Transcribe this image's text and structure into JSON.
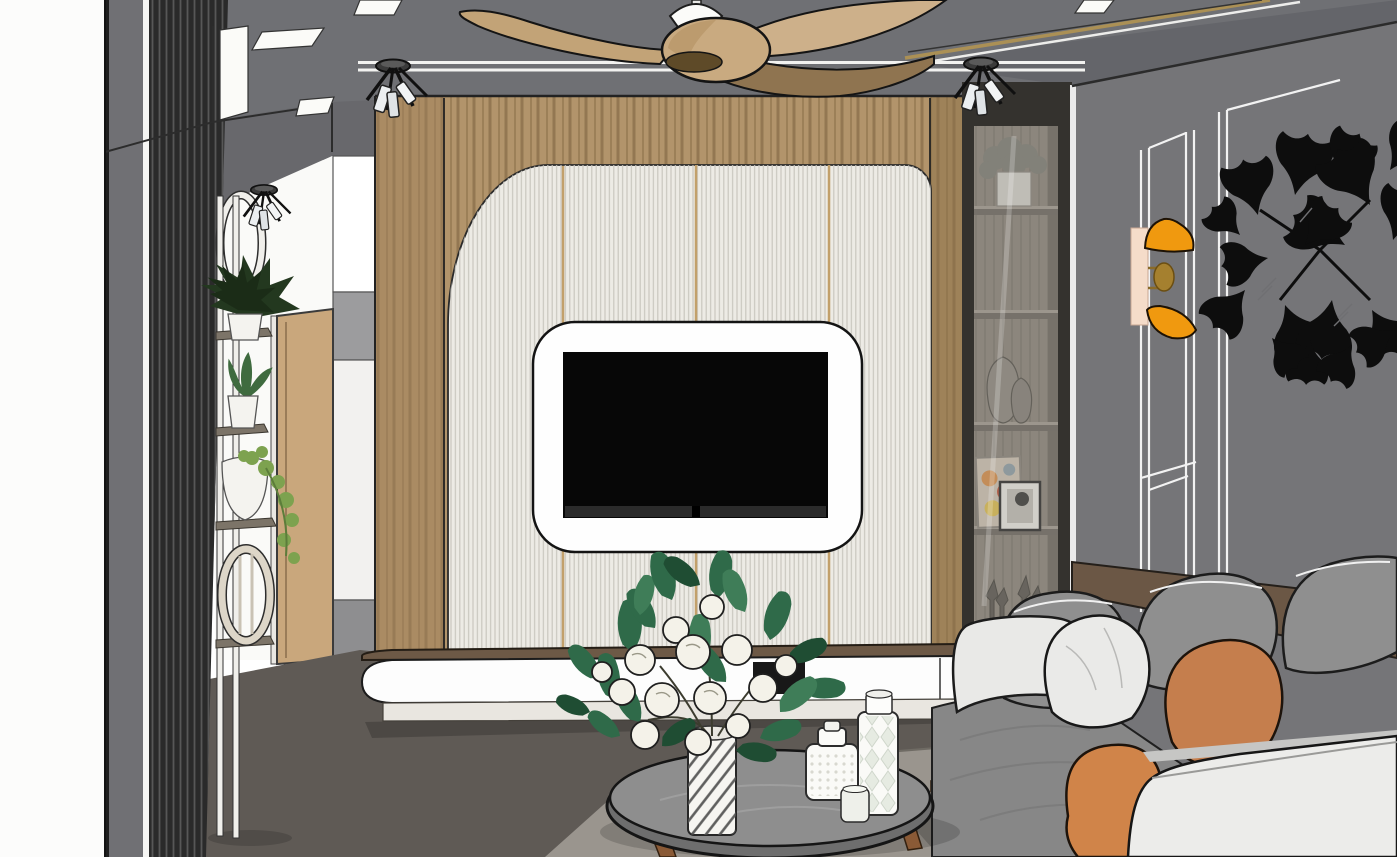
{
  "scene": {
    "objects": [
      "left-wall-slat-screen",
      "plant-stand",
      "hallway-door",
      "hallway-cabinet",
      "ceiling-fan",
      "ceiling-spotlights",
      "recessed-light-panels",
      "tv-feature-wall",
      "fluted-panels",
      "wall-mounted-tv",
      "tv-cabinet",
      "glass-display-cabinet",
      "display-plant",
      "display-vases",
      "display-frames",
      "display-figurines",
      "paneled-wall",
      "wall-sconce",
      "ginkgo-wall-art",
      "sofa",
      "throw-pillows",
      "coffee-table",
      "flower-vase",
      "canister-set",
      "rug"
    ]
  },
  "colors": {
    "left_margin": "#fcfcfb",
    "ceiling": "#6f7074",
    "ceiling_band": "#64656a",
    "soffit": "#68686c",
    "light_panel": "#fbfbf8",
    "hall_wall": "#fafaf8",
    "left_wall_band": "#707074",
    "slat_dark": "#2a2a2a",
    "door_wood": "#c9a77c",
    "door_jamb": "#e9e7e2",
    "cab_white": "#f2f1ef",
    "cab_gray": "#9c9c9e",
    "stand_white": "#f0efeb",
    "pot_white": "#f4f3ef",
    "fern_green": "#23381f",
    "agave_green": "#3f6b3f",
    "pothos_green": "#7da24f",
    "wood_wall": "#b2946b",
    "wood_pillar": "#a0815a",
    "flute_panel": "#edebe5",
    "gold_trim": "#c2a06b",
    "tv_frame": "#fefefe",
    "tv_screen": "#070707",
    "cabinet_top_wood": "#6d5946",
    "cabinet_body": "#fdfdfd",
    "cabinet_plinth": "#e9e6e0",
    "media_niche": "#181818",
    "shelf_frame": "#34322e",
    "shelf_interior": "#8d867c",
    "shelf_board": "#9a948a",
    "right_wall": "#757578",
    "molding_white": "#f2f2f2",
    "sconce_orange": "#f0990f",
    "sconce_bar": "#f5dcc9",
    "sconce_gold": "#a5802f",
    "art_black": "#0d0d0d",
    "sofa_gray": "#8f8f8f",
    "sofa_seat": "#878787",
    "sofa_arm_white": "#e9e9e7",
    "sofa_front_white": "#ececea",
    "pillow_white": "#eaeae8",
    "pillow_orange": "#c57e4d",
    "pillow_orange2": "#d08449",
    "sofa_rail_wood": "#6b5745",
    "sofa_base": "#4a3c2e",
    "floor": "#5f5a55",
    "rug": "#9a958e",
    "table_top": "#8e8e8e",
    "table_rim": "#6e6e6e",
    "table_leg": "#8a5a36",
    "vase_white": "#f6f5f1",
    "flower_white": "#f4f2e9",
    "leaf_green": "#2f6a49",
    "canister_white": "#fafaf7",
    "fan_blade": "#c2a377",
    "fan_blade_dark": "#8f7450",
    "fan_hub": "#c9aa80"
  }
}
